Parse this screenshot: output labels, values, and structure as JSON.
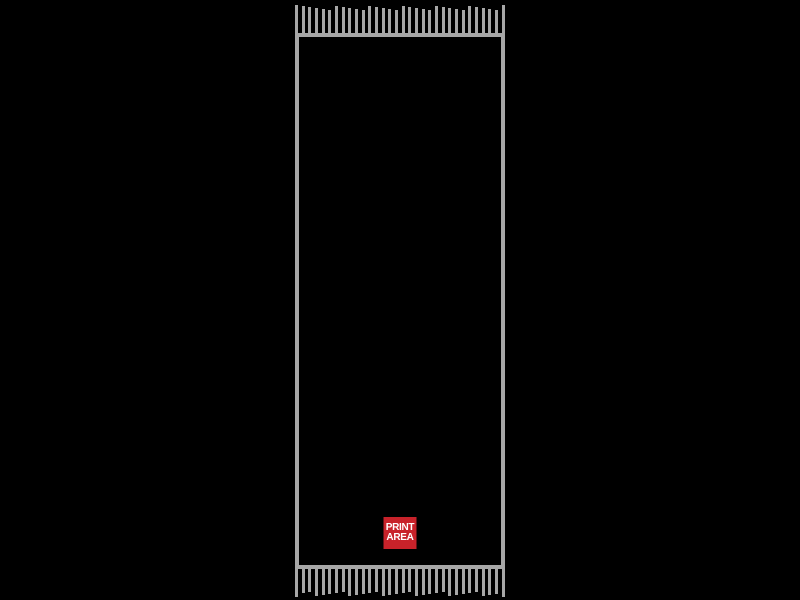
{
  "page": {
    "background_color": "#000000"
  },
  "scarf": {
    "outline_color": "#a7a7a7",
    "body_color": "#000000",
    "fringe_tassel_count": 32
  },
  "print_area": {
    "line1": "PRINT",
    "line2": "AREA",
    "background_color": "#c8222a",
    "text_color": "#ffffff"
  }
}
